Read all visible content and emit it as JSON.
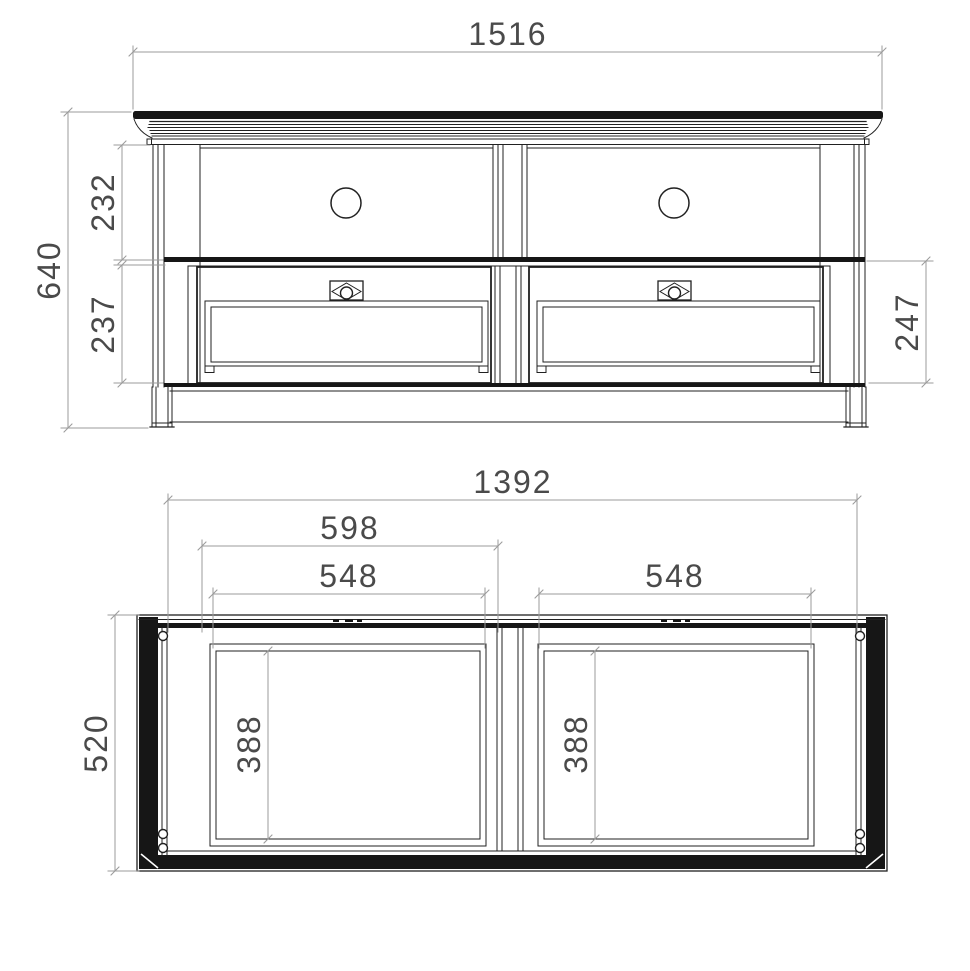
{
  "page": {
    "background": "#ffffff"
  },
  "drawing": {
    "type": "furniture-technical-drawing",
    "line_color": "#212121",
    "dimension_line_color": "#9b9b9b",
    "dimension_text_color": "#4a4a4a",
    "front_view": {
      "dimensions": {
        "overall_width": "1516",
        "overall_height": "640",
        "open_shelf_height": "232",
        "drawer_front_height": "237",
        "drawer_section_height": "247"
      }
    },
    "plan_view": {
      "dimensions": {
        "carcass_width": "1392",
        "overall_depth": "520",
        "left_section_width": "598",
        "left_opening_width": "548",
        "right_opening_width": "548",
        "left_opening_depth": "388",
        "right_opening_depth": "388"
      }
    }
  }
}
